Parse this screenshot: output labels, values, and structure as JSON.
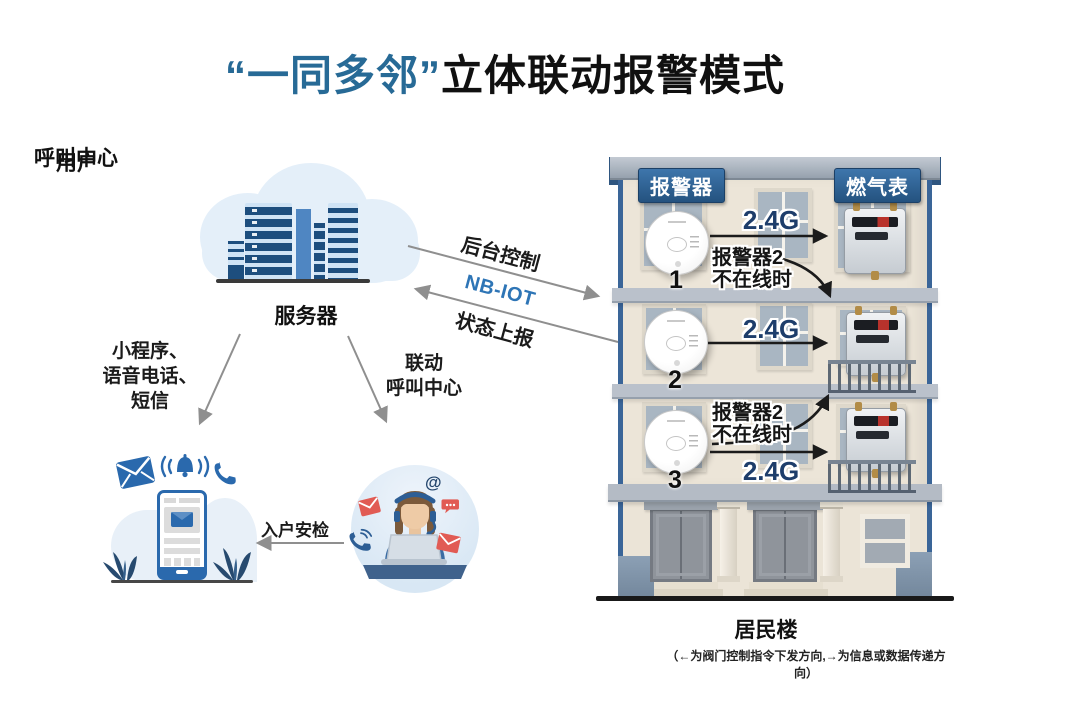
{
  "title": {
    "highlight": "“一同多邻”",
    "rest": "立体联动报警模式"
  },
  "colors": {
    "title_blue": "#276a96",
    "nbiot_blue": "#2e75b6",
    "link_navy": "#1d3d6b",
    "header_badge_blue": "#24527f",
    "arrow_gray": "#8f8f8f",
    "arrow_black": "#1b1b1b",
    "alert_red": "#e15b54",
    "facade_cream": "#ece5d8"
  },
  "server": {
    "label": "服务器"
  },
  "links": {
    "backend_control": "后台控制",
    "nbiot": "NB-IOT",
    "status_report": "状态上报",
    "user_channels": [
      "小程序、",
      "语音电话、",
      "短信"
    ],
    "linkage": [
      "联动",
      "呼叫中心"
    ],
    "inspection": "入户安检"
  },
  "user": {
    "label": "用户"
  },
  "call_center": {
    "label": "呼叫中心",
    "at_symbol": "@"
  },
  "building": {
    "alarm_header": "报警器",
    "meter_header": "燃气表",
    "floors": [
      {
        "no": "1",
        "link": "2.4G",
        "fallback_l1": "报警器2",
        "fallback_l2": "不在线时"
      },
      {
        "no": "2",
        "link": "2.4G"
      },
      {
        "no": "3",
        "link": "2.4G",
        "fallback_l1": "报警器2",
        "fallback_l2": "不在线时"
      }
    ],
    "caption": "居民楼",
    "note": "（←为阀门控制指令下发方向,→为信息或数据传递方向）"
  }
}
